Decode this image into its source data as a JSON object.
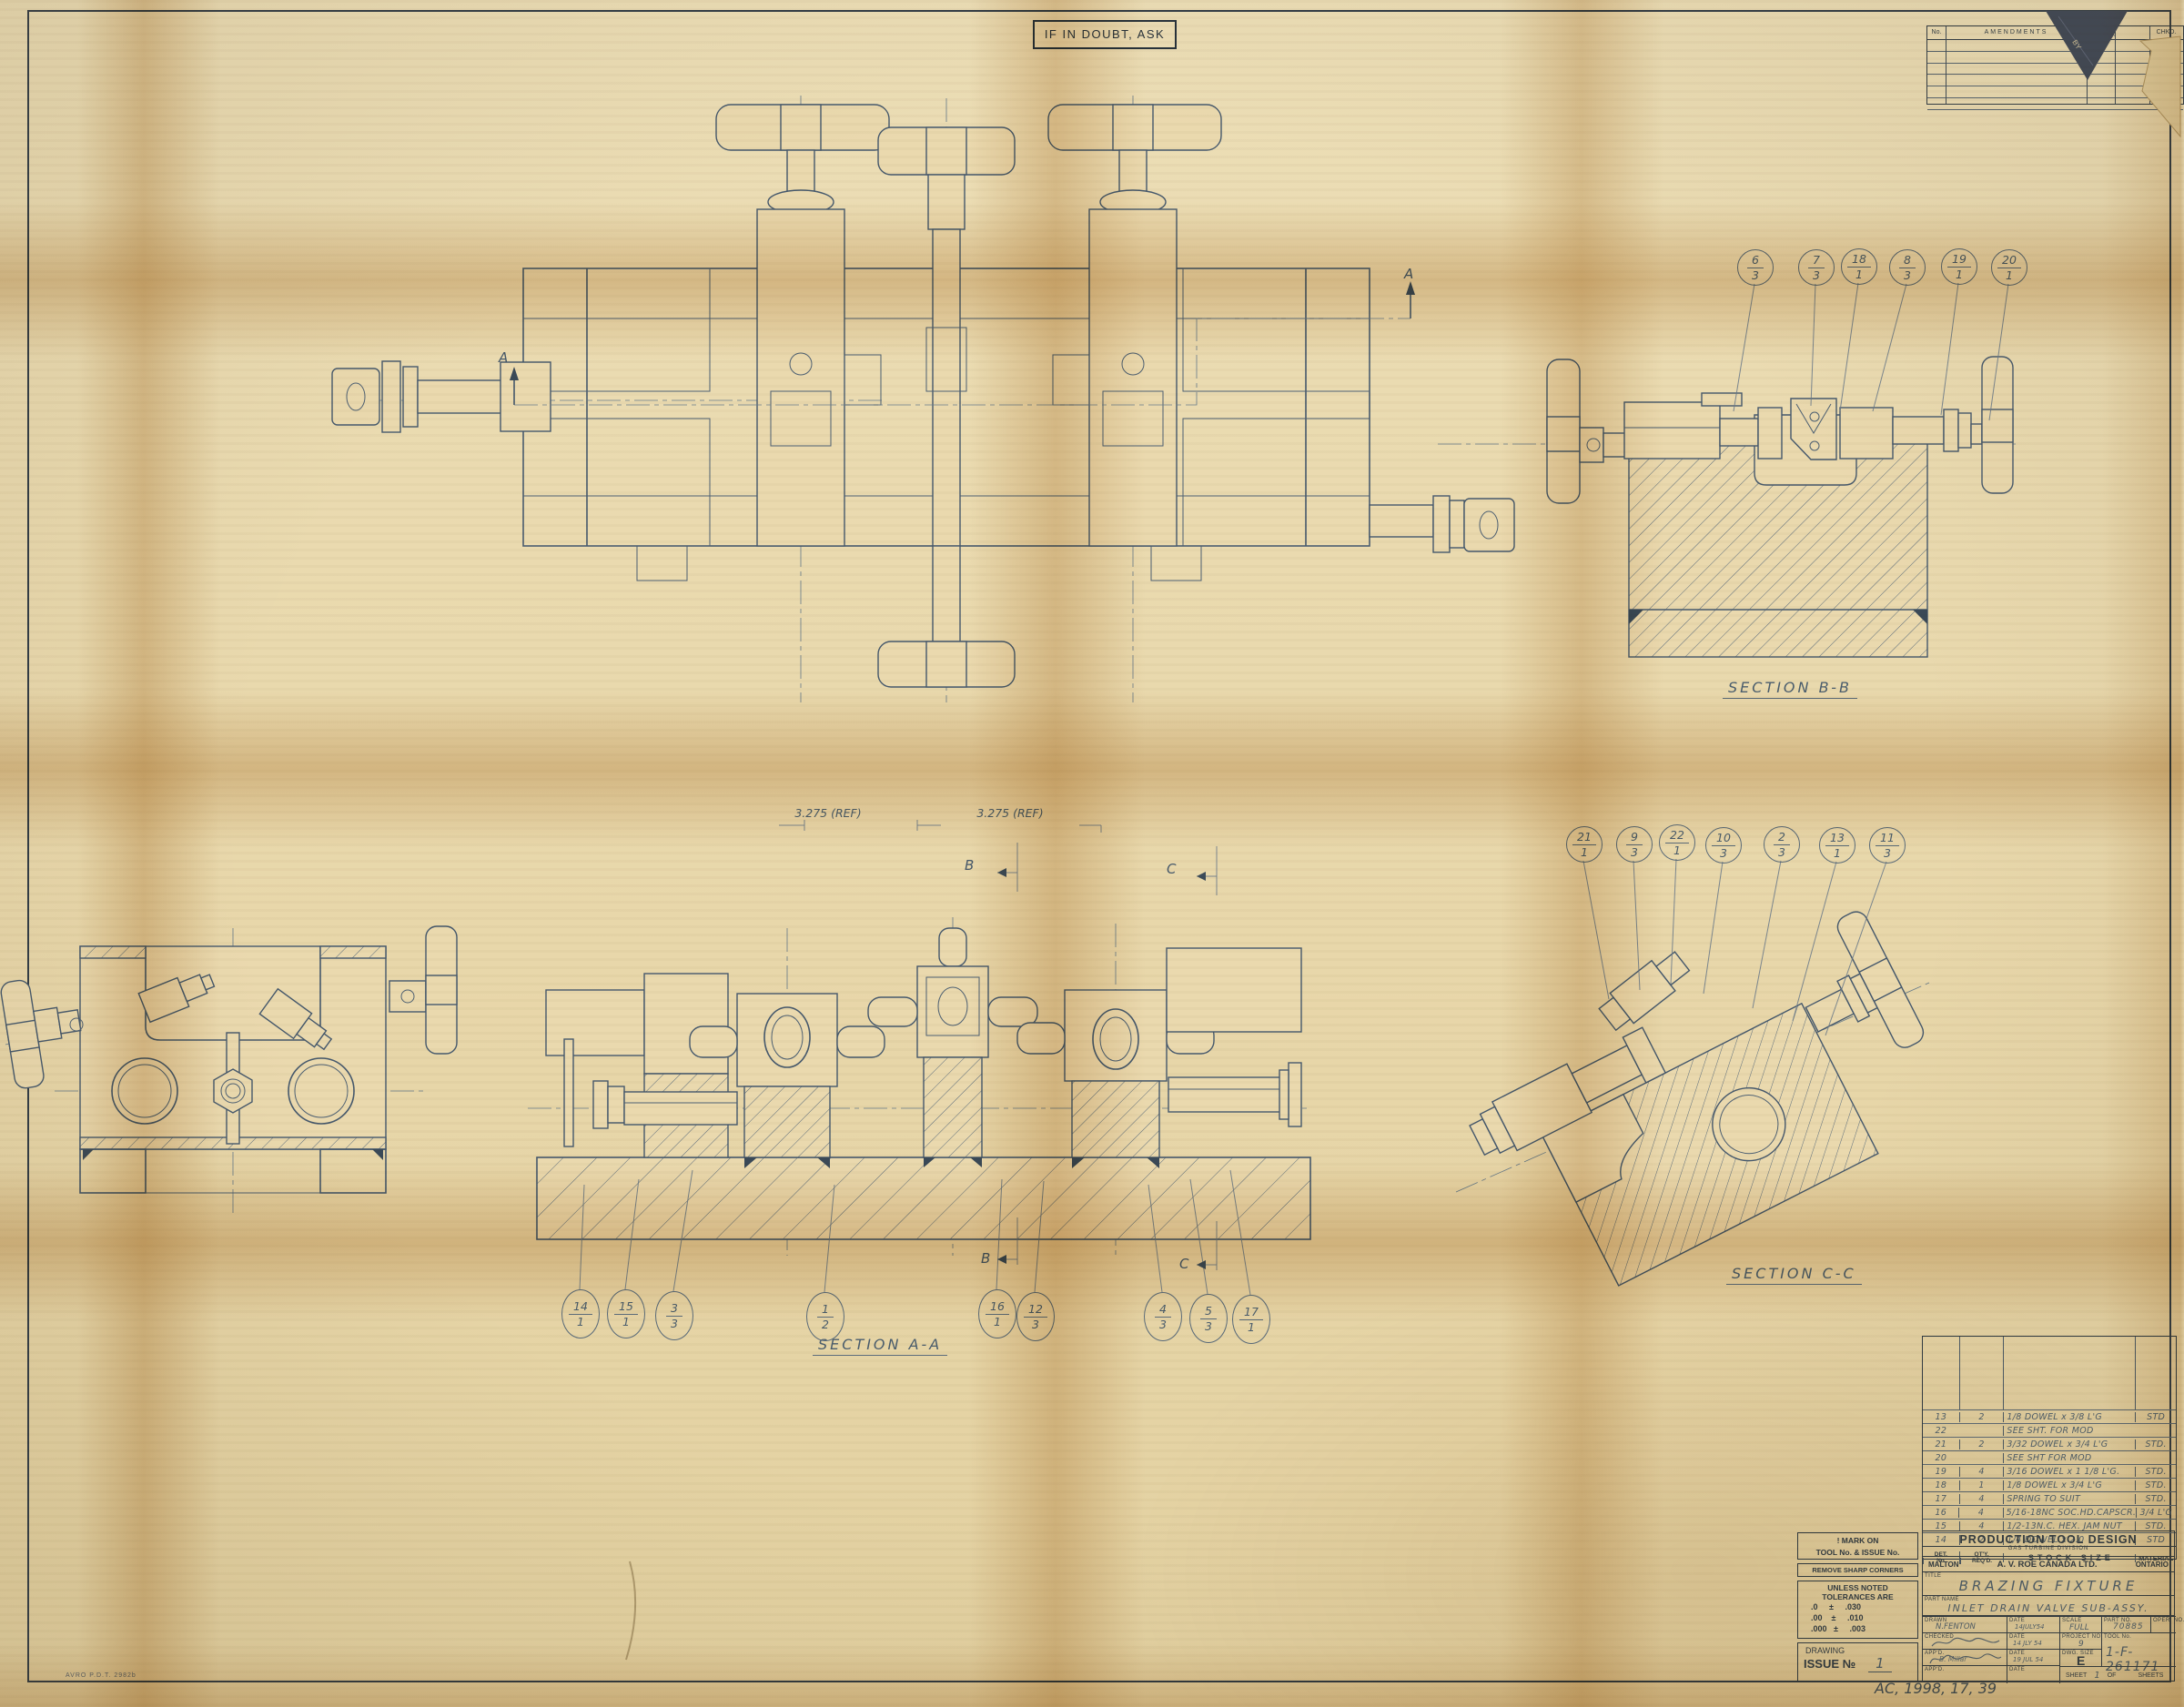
{
  "sheet": {
    "caution": "IF IN DOUBT, ASK",
    "plate_code": "AVRO P.D.T. 2982b",
    "archive_note": "AC, 1998, 17, 39"
  },
  "amendments": {
    "col_no": "No.",
    "col_amendments": "AMENDMENTS",
    "col_by": "BY",
    "col_date": "DATE",
    "col_chkd": "CHKD."
  },
  "labels": {
    "section_aa": "SECTION A-A",
    "section_bb": "SECTION B-B",
    "section_cc": "SECTION C-C",
    "dim_ref_1": "3.275 (REF)",
    "dim_ref_2": "3.275 (REF)",
    "marker_a": "A",
    "marker_b": "B",
    "marker_c": "C"
  },
  "balloons": {
    "bb": [
      {
        "det": "6",
        "qty": "3"
      },
      {
        "det": "7",
        "qty": "3"
      },
      {
        "det": "18",
        "qty": "1"
      },
      {
        "det": "8",
        "qty": "3"
      },
      {
        "det": "19",
        "qty": "1"
      },
      {
        "det": "20",
        "qty": "1"
      }
    ],
    "cc": [
      {
        "det": "21",
        "qty": "1"
      },
      {
        "det": "9",
        "qty": "3"
      },
      {
        "det": "22",
        "qty": "1"
      },
      {
        "det": "10",
        "qty": "3"
      },
      {
        "det": "2",
        "qty": "3"
      },
      {
        "det": "13",
        "qty": "1"
      },
      {
        "det": "11",
        "qty": "3"
      }
    ],
    "aa": [
      {
        "det": "14",
        "qty": "1"
      },
      {
        "det": "15",
        "qty": "1"
      },
      {
        "det": "3",
        "qty": "3"
      },
      {
        "det": "1",
        "qty": "2"
      },
      {
        "det": "16",
        "qty": "1"
      },
      {
        "det": "12",
        "qty": "3"
      },
      {
        "det": "4",
        "qty": "3"
      },
      {
        "det": "5",
        "qty": "3"
      },
      {
        "det": "17",
        "qty": "1"
      }
    ]
  },
  "parts": {
    "header_det_1": "DET.",
    "header_det_2": "No.",
    "header_qty_1": "QT'Y.",
    "header_qty_2": "REQ'D.",
    "header_stock": "STOCK SIZE",
    "header_material": "MATERIAL",
    "rows": [
      {
        "det": "13",
        "qty": "2",
        "stock": "1/8 DOWEL x 3/8 L'G",
        "mat": "STD"
      },
      {
        "det": "22",
        "qty": "",
        "stock": "SEE SHT. FOR MOD",
        "mat": ""
      },
      {
        "det": "21",
        "qty": "2",
        "stock": "3/32 DOWEL x 3/4 L'G",
        "mat": "STD."
      },
      {
        "det": "20",
        "qty": "",
        "stock": "SEE SHT FOR MOD",
        "mat": ""
      },
      {
        "det": "19",
        "qty": "4",
        "stock": "3/16 DOWEL x 1 1/8 L'G.",
        "mat": "STD."
      },
      {
        "det": "18",
        "qty": "1",
        "stock": "1/8 DOWEL x 3/4 L'G",
        "mat": "STD."
      },
      {
        "det": "17",
        "qty": "4",
        "stock": "SPRING TO SUIT",
        "mat": "STD."
      },
      {
        "det": "16",
        "qty": "4",
        "stock": "5/16-18NC SOC.HD.CAPSCR.",
        "mat": "3/4 L'G"
      },
      {
        "det": "15",
        "qty": "4",
        "stock": "1/2-13N.C. HEX. JAM NUT",
        "mat": "STD."
      },
      {
        "det": "14",
        "qty": "2",
        "stock": "1/4 DOWEL x 2.0",
        "mat": "STD"
      }
    ]
  },
  "title_block": {
    "mark_on_1": "! MARK ON",
    "mark_on_2": "TOOL No. & ISSUE No.",
    "remove": "REMOVE SHARP CORNERS",
    "tol_head_1": "UNLESS NOTED",
    "tol_head_2": "TOLERANCES ARE",
    "tol_1": ".0     ±     .030",
    "tol_2": ".00    ±     .010",
    "tol_3": ".000   ±     .003",
    "drawing_label": "DRAWING",
    "issue_label": "ISSUE №",
    "issue_value": "1",
    "org_title": "PRODUCTION TOOL DESIGN",
    "org_sub": "GAS TURBINE DIVISION",
    "org_left": "MALTON",
    "org_name": "A. V. ROE CANADA LTD.",
    "org_right": "ONTARIO",
    "title_label": "TITLE",
    "title_value": "BRAZING FIXTURE",
    "part_name_label": "PART NAME",
    "part_name_value": "INLET DRAIN VALVE SUB-ASSY.",
    "drawn_label": "DRAWN",
    "drawn_value": "N.FENTON",
    "date_label": "DATE",
    "drawn_date": "14JULY54",
    "checked_label": "CHECKED",
    "checked_date": "14 JLY 54",
    "appd_label": "APP'D.",
    "appd_value": "B. Millar",
    "appd_date": "19 JUL 54",
    "scale_label": "SCALE",
    "scale_value": "FULL",
    "part_no_label": "PART NO.",
    "part_no_value": "70885",
    "oper_no_label": "OPER. NO.",
    "project_label": "PROJECT NO.",
    "project_value": "9",
    "tool_no_label": "TOOL No.",
    "tool_no_value": "1-F-261171",
    "dwg_size_label": "DWG. SIZE",
    "dwg_size_value": "E",
    "sheet_label_1": "SHEET",
    "sheet_value": "1",
    "sheet_label_2": "OF",
    "sheet_label_3": "SHEETS"
  }
}
